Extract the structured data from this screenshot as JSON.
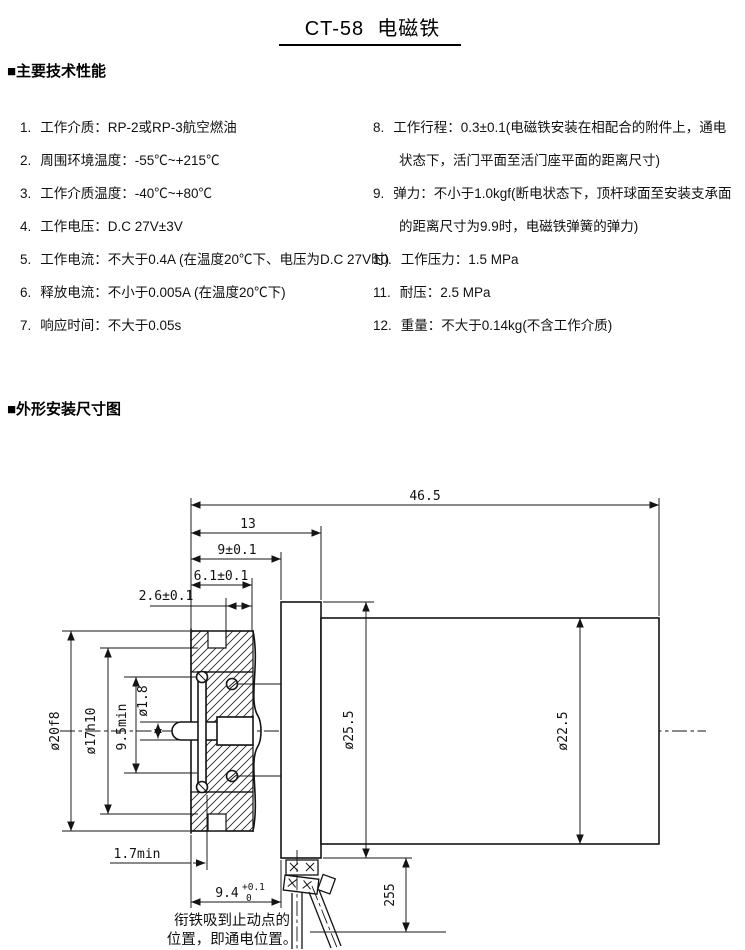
{
  "page": {
    "title": "CT-58  电磁铁"
  },
  "specs": {
    "heading": "■主要技术性能",
    "left": [
      {
        "num": "1.",
        "text": "工作介质：RP-2或RP-3航空燃油"
      },
      {
        "num": "2.",
        "text": "周围环境温度：-55℃~+215℃"
      },
      {
        "num": "3.",
        "text": "工作介质温度：-40℃~+80℃"
      },
      {
        "num": "4.",
        "text": "工作电压：D.C 27V±3V"
      },
      {
        "num": "5.",
        "text": "工作电流：不大于0.4A (在温度20℃下、电压为D.C 27V时)"
      },
      {
        "num": "6.",
        "text": "释放电流：不小于0.005A (在温度20℃下)"
      },
      {
        "num": "7.",
        "text": "响应时间：不大于0.05s"
      }
    ],
    "right": [
      {
        "num": "8.",
        "line1": "工作行程：0.3±0.1(电磁铁安装在相配合的附件上，通电",
        "line2": "状态下，活门平面至活门座平面的距离尺寸)"
      },
      {
        "num": "9.",
        "line1": "弹力：不小于1.0kgf(断电状态下，顶杆球面至安装支承面",
        "line2": "的距离尺寸为9.9时，电磁铁弹簧的弹力)"
      },
      {
        "num": "10.",
        "line1": "工作压力：1.5 MPa"
      },
      {
        "num": "11.",
        "line1": "耐压：2.5 MPa"
      },
      {
        "num": "12.",
        "line1": "重量：不大于0.14kg(不含工作介质)"
      }
    ]
  },
  "drawing": {
    "heading": "■外形安装尺寸图",
    "dims": {
      "total_length": "46.5",
      "len_13": "13",
      "len_9": "9±0.1",
      "len_6_1": "6.1±0.1",
      "len_2_6": "2.6±0.1",
      "dia_20": "ø20f8",
      "dia_17": "ø17h10",
      "len_9_5": "9.5min",
      "dia_1_8": "ø1.8",
      "dia_25_5": "ø25.5",
      "dia_22_5": "ø22.5",
      "len_1_7": "1.7min",
      "len_9_4": "9.4",
      "len_9_4_tol_up": "+0.1",
      "len_9_4_tol_low": "0",
      "wire_len": "255"
    },
    "note": {
      "line1": "衔铁吸到止动点的",
      "line2": "位置，即通电位置。"
    }
  }
}
